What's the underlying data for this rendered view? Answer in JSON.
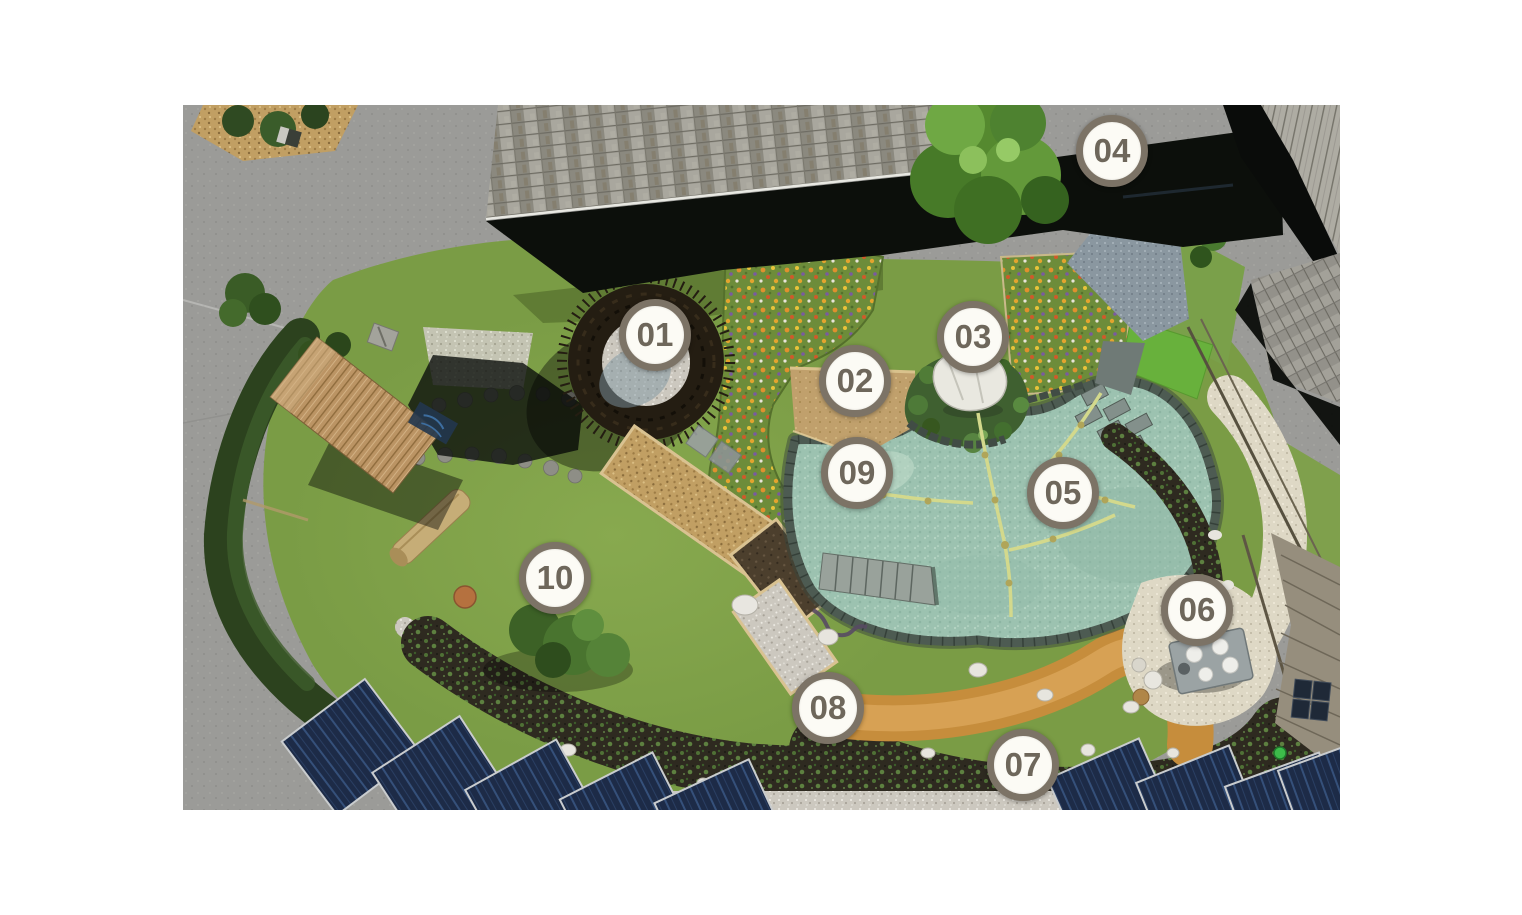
{
  "page": {
    "background_color": "#ffffff",
    "description": "Aerial photograph of a natural garden with swimming pond, numbered station markers 01-10"
  },
  "photo": {
    "x": 183,
    "y": 105,
    "width": 1157,
    "height": 705
  },
  "marker_style": {
    "fill_color": "#fcfbf5",
    "border_color": "#7c7366",
    "text_color": "#6e675b"
  },
  "markers": [
    {
      "label": "01",
      "x": 655,
      "y": 335
    },
    {
      "label": "02",
      "x": 855,
      "y": 381
    },
    {
      "label": "03",
      "x": 973,
      "y": 337
    },
    {
      "label": "04",
      "x": 1112,
      "y": 151
    },
    {
      "label": "05",
      "x": 1063,
      "y": 493
    },
    {
      "label": "06",
      "x": 1197,
      "y": 610
    },
    {
      "label": "07",
      "x": 1023,
      "y": 765
    },
    {
      "label": "08",
      "x": 828,
      "y": 708
    },
    {
      "label": "09",
      "x": 857,
      "y": 473
    },
    {
      "label": "10",
      "x": 555,
      "y": 578
    }
  ],
  "scene_palette": {
    "lawn_green": "#7a9c45",
    "hedge_dark_green": "#2c421e",
    "pond_water": "#9cc2b0",
    "pond_stone_edge": "#4d5b52",
    "sand_beach": "#c0a06c",
    "island_rock_white": "#e9e8e0",
    "flower_meadow": "#6d8c3a",
    "roof_shingle_gray": "#9a988f",
    "roof_shadow_black": "#0c0f0b",
    "asphalt_gray": "#a2a29f",
    "gravel_cream_path": "#ded8c5",
    "clay_path_orange": "#c68d3c",
    "soil_bed_dark": "#2e2a20",
    "solar_panel_blue": "#1d2b47",
    "wood_pergola": "#bb9464"
  }
}
